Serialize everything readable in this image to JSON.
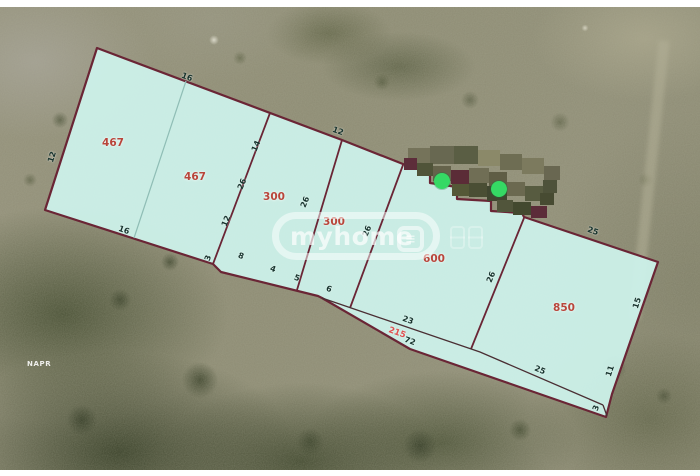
{
  "map": {
    "type": "cadastral-parcel-overlay-on-aerial-photo",
    "colors": {
      "parcel_fill": "rgba(206,243,236,0.93)",
      "boundary": "#6a2535",
      "thin_divider": "#8fbdb5",
      "strip_line": "#4a2e33",
      "area_label": "#b8453a",
      "dimension_label": "#17332d",
      "total_length_label": "#e05050",
      "marker_green": "#35d964"
    },
    "parcels": [
      {
        "area": "467",
        "x": 113,
        "y": 143
      },
      {
        "area": "467",
        "x": 195,
        "y": 177
      },
      {
        "area": "300",
        "x": 274,
        "y": 197
      },
      {
        "area": "300",
        "x": 334,
        "y": 222
      },
      {
        "area": "600",
        "x": 434,
        "y": 259
      },
      {
        "area": "850",
        "x": 564,
        "y": 308
      }
    ],
    "dimension_labels": [
      {
        "text": "16",
        "x": 187,
        "y": 77,
        "rot": 21
      },
      {
        "text": "12",
        "x": 338,
        "y": 131,
        "rot": 20
      },
      {
        "text": "12",
        "x": 52,
        "y": 157,
        "rot": -73
      },
      {
        "text": "16",
        "x": 124,
        "y": 230,
        "rot": 20
      },
      {
        "text": "14",
        "x": 256,
        "y": 146,
        "rot": -68
      },
      {
        "text": "26",
        "x": 242,
        "y": 184,
        "rot": -68
      },
      {
        "text": "12",
        "x": 226,
        "y": 221,
        "rot": -68
      },
      {
        "text": "26",
        "x": 305,
        "y": 202,
        "rot": -68
      },
      {
        "text": "26",
        "x": 367,
        "y": 231,
        "rot": -68
      },
      {
        "text": "26",
        "x": 491,
        "y": 277,
        "rot": -68
      },
      {
        "text": "25",
        "x": 593,
        "y": 231,
        "rot": 19
      },
      {
        "text": "15",
        "x": 637,
        "y": 303,
        "rot": -72
      },
      {
        "text": "25",
        "x": 540,
        "y": 370,
        "rot": 23
      },
      {
        "text": "11",
        "x": 610,
        "y": 371,
        "rot": -72
      },
      {
        "text": "3",
        "x": 596,
        "y": 408,
        "rot": -70
      },
      {
        "text": "23",
        "x": 408,
        "y": 320,
        "rot": 20
      },
      {
        "text": "215",
        "x": 397,
        "y": 333,
        "rot": 20,
        "red": true
      },
      {
        "text": "72",
        "x": 410,
        "y": 341,
        "rot": 20
      },
      {
        "text": "3",
        "x": 208,
        "y": 258,
        "rot": -70
      },
      {
        "text": "8",
        "x": 241,
        "y": 256,
        "rot": 20
      },
      {
        "text": "4",
        "x": 273,
        "y": 269,
        "rot": 20
      },
      {
        "text": "5",
        "x": 297,
        "y": 278,
        "rot": 20
      },
      {
        "text": "6",
        "x": 329,
        "y": 289,
        "rot": 20
      }
    ],
    "markers": [
      {
        "x": 442,
        "y": 181
      },
      {
        "x": 499,
        "y": 189
      }
    ],
    "censor_blocks": [
      {
        "x": 408,
        "y": 148,
        "w": 22,
        "h": 17,
        "c": "#75735a"
      },
      {
        "x": 430,
        "y": 146,
        "w": 24,
        "h": 18,
        "c": "#686851"
      },
      {
        "x": 454,
        "y": 146,
        "w": 24,
        "h": 18,
        "c": "#5a5e44"
      },
      {
        "x": 478,
        "y": 150,
        "w": 22,
        "h": 16,
        "c": "#8b8969"
      },
      {
        "x": 500,
        "y": 154,
        "w": 22,
        "h": 16,
        "c": "#6e6d53"
      },
      {
        "x": 522,
        "y": 158,
        "w": 22,
        "h": 16,
        "c": "#7c7a5e"
      },
      {
        "x": 544,
        "y": 166,
        "w": 16,
        "h": 14,
        "c": "#696751"
      },
      {
        "x": 404,
        "y": 158,
        "w": 13,
        "h": 12,
        "c": "#5d2d3a"
      },
      {
        "x": 417,
        "y": 163,
        "w": 16,
        "h": 13,
        "c": "#505439"
      },
      {
        "x": 433,
        "y": 166,
        "w": 18,
        "h": 15,
        "c": "#65634b"
      },
      {
        "x": 451,
        "y": 170,
        "w": 18,
        "h": 14,
        "c": "#5b2c37"
      },
      {
        "x": 469,
        "y": 168,
        "w": 20,
        "h": 15,
        "c": "#706e55"
      },
      {
        "x": 489,
        "y": 172,
        "w": 18,
        "h": 14,
        "c": "#5f5d45"
      },
      {
        "x": 452,
        "y": 184,
        "w": 17,
        "h": 12,
        "c": "#545837"
      },
      {
        "x": 469,
        "y": 183,
        "w": 18,
        "h": 14,
        "c": "#4a4e34"
      },
      {
        "x": 487,
        "y": 186,
        "w": 20,
        "h": 15,
        "c": "#404630"
      },
      {
        "x": 507,
        "y": 182,
        "w": 18,
        "h": 14,
        "c": "#6b6950"
      },
      {
        "x": 525,
        "y": 186,
        "w": 18,
        "h": 15,
        "c": "#575b40"
      },
      {
        "x": 543,
        "y": 180,
        "w": 14,
        "h": 13,
        "c": "#4e523a"
      },
      {
        "x": 497,
        "y": 200,
        "w": 16,
        "h": 12,
        "c": "#51553b"
      },
      {
        "x": 513,
        "y": 202,
        "w": 18,
        "h": 13,
        "c": "#43492f"
      },
      {
        "x": 531,
        "y": 206,
        "w": 16,
        "h": 12,
        "c": "#5c2c39"
      },
      {
        "x": 540,
        "y": 193,
        "w": 14,
        "h": 12,
        "c": "#474b32"
      }
    ],
    "watermark": {
      "brand_text": "myhome",
      "badge_glyph": "≡"
    },
    "agency_watermark": "NAPR"
  }
}
